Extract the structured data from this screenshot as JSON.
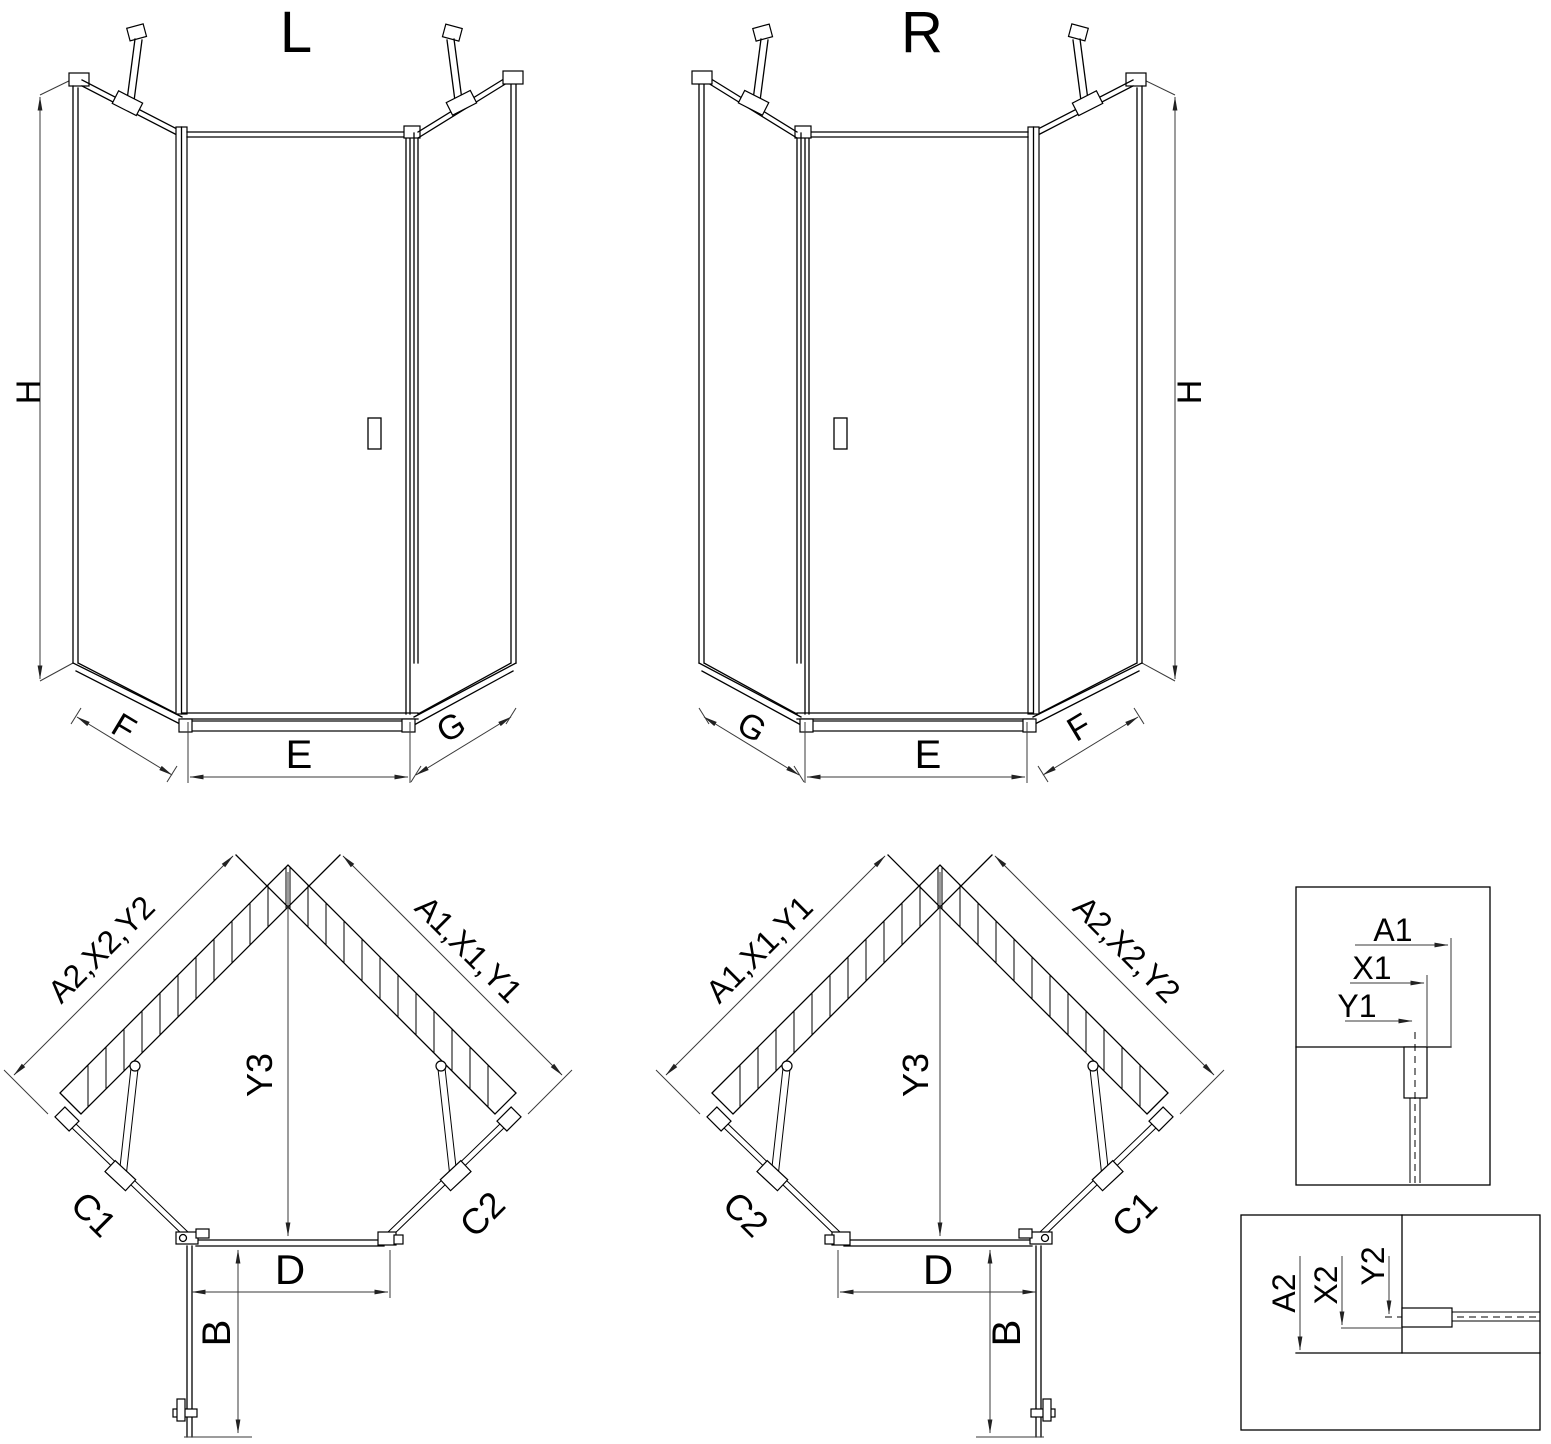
{
  "drawing": {
    "elevation_left": {
      "title": "L",
      "dim_height": "H",
      "dim_side_left": "F",
      "dim_width": "E",
      "dim_side_right": "G"
    },
    "elevation_right": {
      "title": "R",
      "dim_height": "H",
      "dim_side_left": "G",
      "dim_width": "E",
      "dim_side_right": "F"
    },
    "plan_left": {
      "dim_wall_left": "A2,X2,Y2",
      "dim_wall_right": "A1,X1,Y1",
      "dim_depth": "Y3",
      "dim_side_left": "C1",
      "dim_side_right": "C2",
      "dim_entry": "D",
      "dim_door": "B"
    },
    "plan_right": {
      "dim_wall_left": "A1,X1,Y1",
      "dim_wall_right": "A2,X2,Y2",
      "dim_depth": "Y3",
      "dim_side_left": "C2",
      "dim_side_right": "C1",
      "dim_entry": "D",
      "dim_door": "B"
    },
    "detail_top": {
      "dims": [
        "A1",
        "X1",
        "Y1"
      ]
    },
    "detail_bottom": {
      "dims": [
        "A2",
        "X2",
        "Y2"
      ]
    }
  }
}
